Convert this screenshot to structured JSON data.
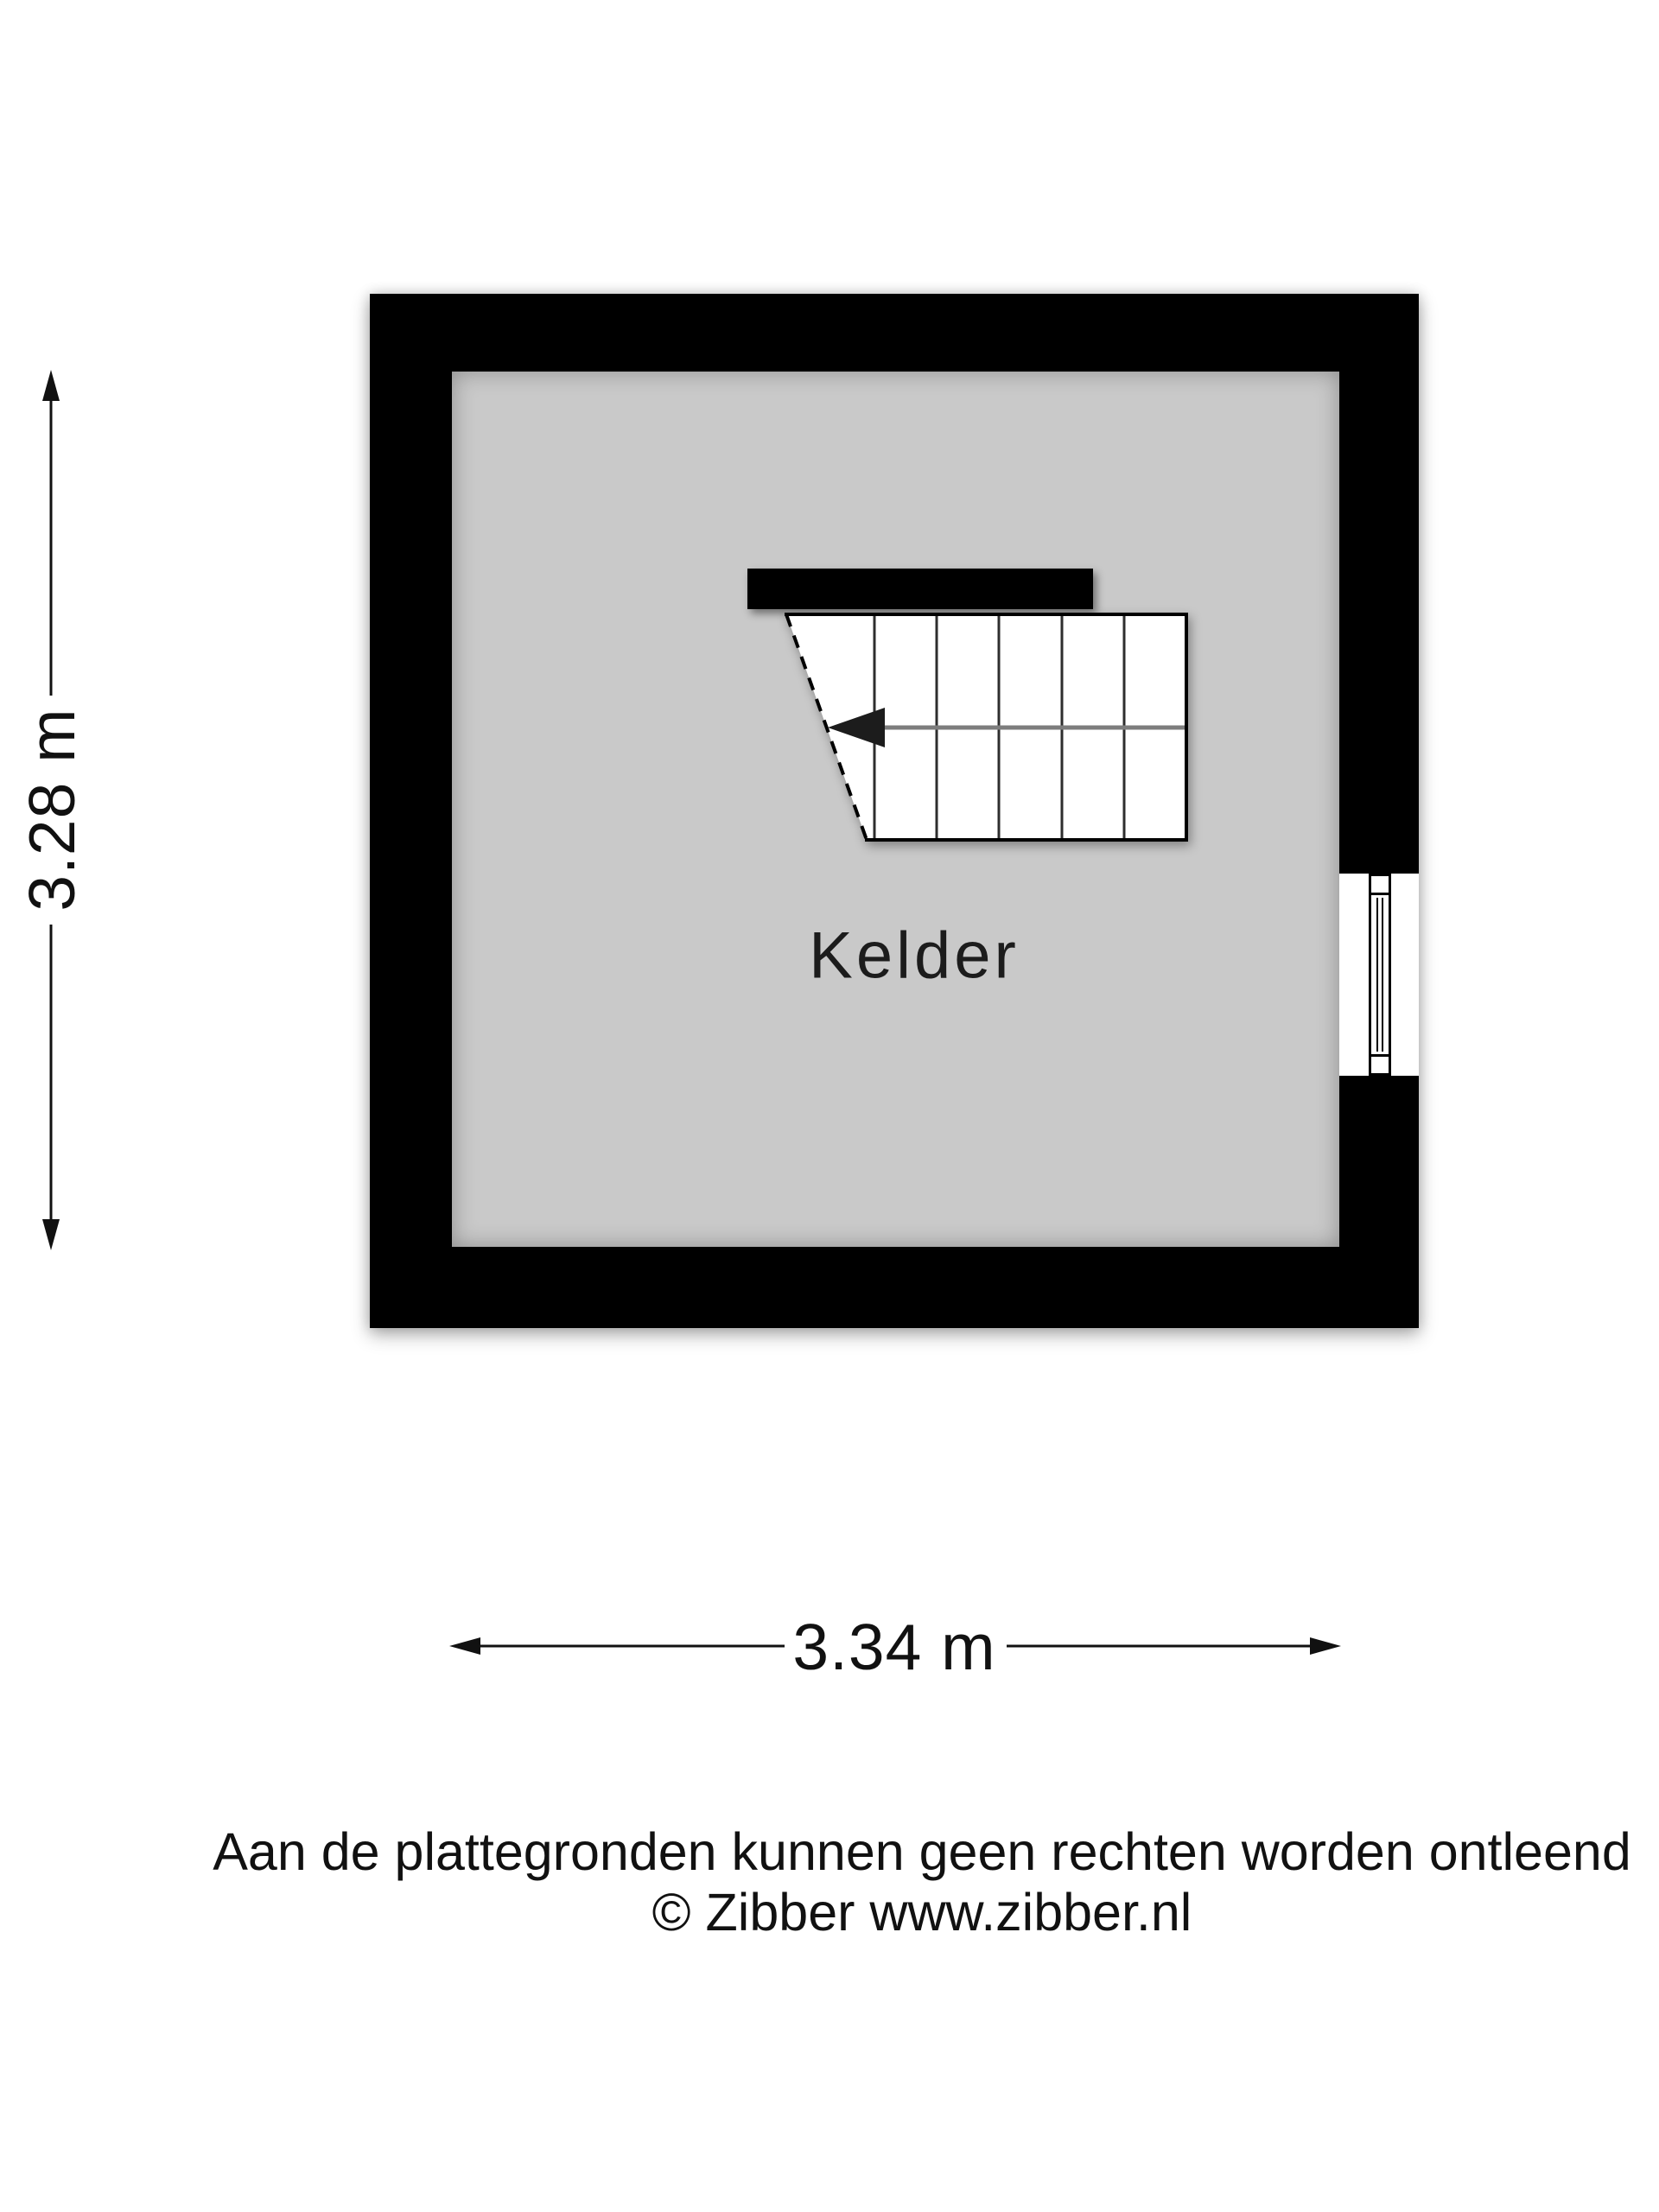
{
  "floorplan": {
    "room_label": "Kelder",
    "width_label": "3.34 m",
    "height_label": "3.28 m",
    "window_wall": "right",
    "stair_tread_count": 6,
    "stair_direction": "left"
  },
  "footer": {
    "disclaimer_line1": "Aan de plattegronden kunnen geen rechten worden ontleend",
    "disclaimer_line2": "© Zibber www.zibber.nl"
  },
  "colors": {
    "wall": "#000000",
    "floor": "#c9c9c9",
    "background": "#ffffff",
    "walkline": "#7d7d7d",
    "text": "#111111"
  },
  "icons": {
    "stair_arrow": "stair-direction-arrow-icon",
    "vertical_dimension": "double-arrow-vertical-icon",
    "horizontal_dimension": "double-arrow-horizontal-icon"
  }
}
